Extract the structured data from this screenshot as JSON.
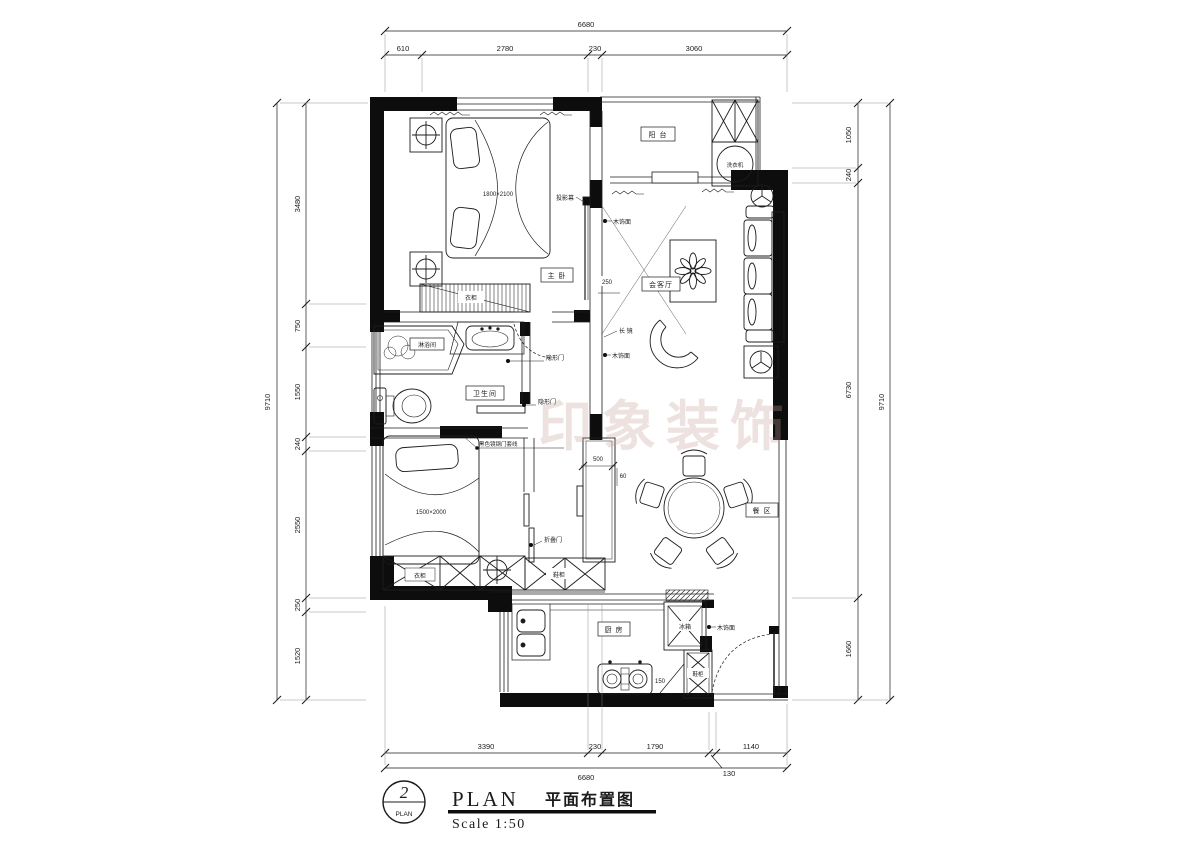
{
  "title_block": {
    "detail_number": "2",
    "detail_circle_label": "PLAN",
    "title_en": "PLAN",
    "title_zh": "平面布置图",
    "scale": "Scale 1:50"
  },
  "watermark": "印象装饰",
  "dims": {
    "top": {
      "total": "6680",
      "segments": [
        "610",
        "2780",
        "230",
        "3060"
      ]
    },
    "bottom": {
      "total": "6680",
      "segments": [
        "3390",
        "230",
        "1790",
        "130",
        "1140"
      ]
    },
    "left": {
      "total": "9710",
      "segments": [
        "3480",
        "750",
        "1550",
        "240",
        "2550",
        "250",
        "1520"
      ]
    },
    "right": {
      "total": "9710",
      "segments": [
        "1050",
        "240",
        "6730",
        "1660"
      ]
    },
    "inner": {
      "screen_offset": "250",
      "cabinet_width": "500",
      "cabinet_depth": "60",
      "stove_gap": "150"
    }
  },
  "rooms": {
    "balcony": "阳 台",
    "master_bedroom": "主 卧",
    "living": "会客厅",
    "bathroom": "卫生间",
    "shower": "淋浴间",
    "dining": "餐 区",
    "kitchen": "厨 房"
  },
  "annotations": {
    "washing_machine": "洗衣机",
    "projection_screen": "投影幕",
    "wood_panel": "木饰面",
    "long_mirror": "长 镜",
    "hidden_door": "隐形门",
    "door_casing": "黑色镜钢门套线",
    "folding_door": "折叠门",
    "fridge": "冰箱",
    "shoe_cabinet": "鞋柜",
    "wardrobe": "衣柜",
    "bed_master": "1800×2100",
    "bed_second": "1500×2000"
  }
}
